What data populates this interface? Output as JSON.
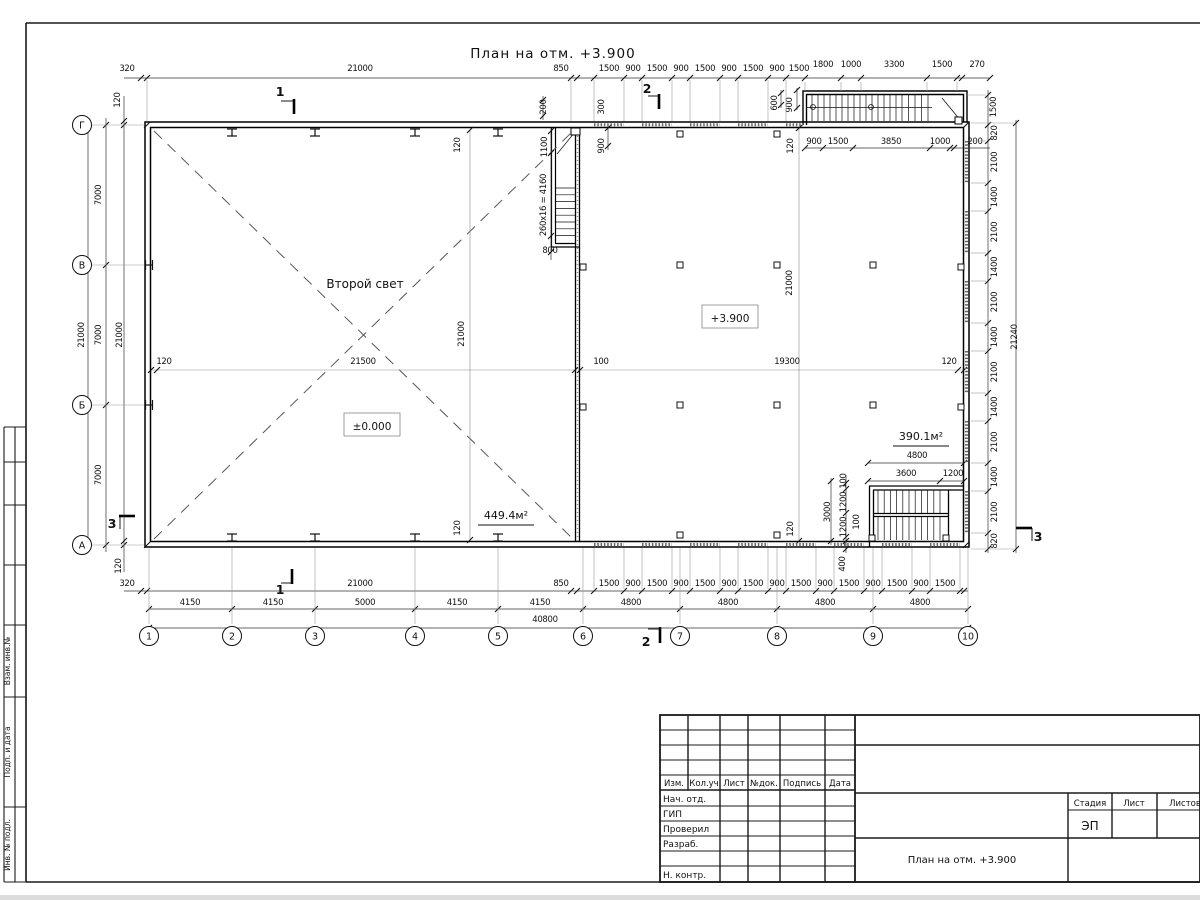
{
  "sheet_title": "План на отм. +3.900",
  "plan": {
    "room_labels": {
      "second_light": "Второй свет",
      "level_zero": "±0.000",
      "level_3900": "+3.900",
      "area_left": "449.4м²",
      "area_right": "390.1м²"
    },
    "axes_left": [
      "Г",
      "В",
      "Б",
      "А"
    ],
    "axes_bottom": [
      "1",
      "2",
      "3",
      "4",
      "5",
      "6",
      "7",
      "8",
      "9",
      "10"
    ],
    "dim_labels": [
      {
        "t": "320",
        "x": 127,
        "y": 71,
        "r": 0
      },
      {
        "t": "21000",
        "x": 360,
        "y": 71,
        "r": 0
      },
      {
        "t": "850",
        "x": 561,
        "y": 71,
        "r": 0
      },
      {
        "t": "1500",
        "x": 609,
        "y": 71,
        "r": 0
      },
      {
        "t": "900",
        "x": 633,
        "y": 71,
        "r": 0
      },
      {
        "t": "1500",
        "x": 657,
        "y": 71,
        "r": 0
      },
      {
        "t": "900",
        "x": 681,
        "y": 71,
        "r": 0
      },
      {
        "t": "1500",
        "x": 705,
        "y": 71,
        "r": 0
      },
      {
        "t": "900",
        "x": 729,
        "y": 71,
        "r": 0
      },
      {
        "t": "1500",
        "x": 753,
        "y": 71,
        "r": 0
      },
      {
        "t": "900",
        "x": 777,
        "y": 71,
        "r": 0
      },
      {
        "t": "1500",
        "x": 799,
        "y": 71,
        "r": 0
      },
      {
        "t": "1800",
        "x": 823,
        "y": 67,
        "r": 0
      },
      {
        "t": "1000",
        "x": 851,
        "y": 67,
        "r": 0
      },
      {
        "t": "3300",
        "x": 894,
        "y": 67,
        "r": 0
      },
      {
        "t": "1500",
        "x": 942,
        "y": 67,
        "r": 0
      },
      {
        "t": "270",
        "x": 977,
        "y": 67,
        "r": 0
      },
      {
        "t": "900",
        "x": 814,
        "y": 144,
        "r": 0
      },
      {
        "t": "1500",
        "x": 838,
        "y": 144,
        "r": 0
      },
      {
        "t": "3850",
        "x": 891,
        "y": 144,
        "r": 0
      },
      {
        "t": "1000",
        "x": 940,
        "y": 144,
        "r": 0
      },
      {
        "t": "200",
        "x": 975,
        "y": 144,
        "r": 0
      },
      {
        "t": "120",
        "x": 120,
        "y": 100,
        "r": 1
      },
      {
        "t": "200",
        "x": 546,
        "y": 107,
        "r": 1
      },
      {
        "t": "300",
        "x": 604,
        "y": 107,
        "r": 1
      },
      {
        "t": "900",
        "x": 604,
        "y": 146,
        "r": 1
      },
      {
        "t": "1100",
        "x": 547,
        "y": 147,
        "r": 1
      },
      {
        "t": "260x16 = 4160",
        "x": 546,
        "y": 205,
        "r": 1
      },
      {
        "t": "800",
        "x": 550,
        "y": 253,
        "r": 0
      },
      {
        "t": "600",
        "x": 777,
        "y": 103,
        "r": 1
      },
      {
        "t": "900",
        "x": 792,
        "y": 105,
        "r": 1
      },
      {
        "t": "120",
        "x": 793,
        "y": 146,
        "r": 1
      },
      {
        "t": "120",
        "x": 460,
        "y": 145,
        "r": 1
      },
      {
        "t": "120",
        "x": 460,
        "y": 528,
        "r": 1
      },
      {
        "t": "120",
        "x": 793,
        "y": 529,
        "r": 1
      },
      {
        "t": "1500",
        "x": 996,
        "y": 107,
        "r": 1
      },
      {
        "t": "820",
        "x": 997,
        "y": 133,
        "r": 1
      },
      {
        "t": "2100",
        "x": 997,
        "y": 162,
        "r": 1
      },
      {
        "t": "1400",
        "x": 997,
        "y": 197,
        "r": 1
      },
      {
        "t": "2100",
        "x": 997,
        "y": 232,
        "r": 1
      },
      {
        "t": "1400",
        "x": 997,
        "y": 267,
        "r": 1
      },
      {
        "t": "2100",
        "x": 997,
        "y": 302,
        "r": 1
      },
      {
        "t": "1400",
        "x": 997,
        "y": 337,
        "r": 1
      },
      {
        "t": "2100",
        "x": 997,
        "y": 372,
        "r": 1
      },
      {
        "t": "1400",
        "x": 997,
        "y": 407,
        "r": 1
      },
      {
        "t": "2100",
        "x": 997,
        "y": 442,
        "r": 1
      },
      {
        "t": "1400",
        "x": 997,
        "y": 477,
        "r": 1
      },
      {
        "t": "2100",
        "x": 997,
        "y": 512,
        "r": 1
      },
      {
        "t": "820",
        "x": 997,
        "y": 541,
        "r": 1
      },
      {
        "t": "21240",
        "x": 1017,
        "y": 337,
        "r": 1
      },
      {
        "t": "7000",
        "x": 101,
        "y": 195,
        "r": 1
      },
      {
        "t": "7000",
        "x": 101,
        "y": 335,
        "r": 1
      },
      {
        "t": "7000",
        "x": 101,
        "y": 475,
        "r": 1
      },
      {
        "t": "21000",
        "x": 84,
        "y": 335,
        "r": 1
      },
      {
        "t": "21000",
        "x": 122,
        "y": 335,
        "r": 1
      },
      {
        "t": "120",
        "x": 121,
        "y": 566,
        "r": 1
      },
      {
        "t": "120",
        "x": 164,
        "y": 364,
        "r": 0
      },
      {
        "t": "21500",
        "x": 363,
        "y": 364,
        "r": 0
      },
      {
        "t": "100",
        "x": 601,
        "y": 364,
        "r": 0
      },
      {
        "t": "19300",
        "x": 787,
        "y": 364,
        "r": 0
      },
      {
        "t": "120",
        "x": 949,
        "y": 364,
        "r": 0
      },
      {
        "t": "21000",
        "x": 464,
        "y": 334,
        "r": 1
      },
      {
        "t": "21000",
        "x": 792,
        "y": 283,
        "r": 1
      },
      {
        "t": "4800",
        "x": 917,
        "y": 458,
        "r": 0
      },
      {
        "t": "3600",
        "x": 906,
        "y": 476,
        "r": 0
      },
      {
        "t": "1200",
        "x": 953,
        "y": 476,
        "r": 0
      },
      {
        "t": "100",
        "x": 846,
        "y": 481,
        "r": 1
      },
      {
        "t": "1200",
        "x": 846,
        "y": 502,
        "r": 1
      },
      {
        "t": "1200",
        "x": 846,
        "y": 527,
        "r": 1
      },
      {
        "t": "100",
        "x": 859,
        "y": 522,
        "r": 1
      },
      {
        "t": "3000",
        "x": 830,
        "y": 512,
        "r": 1
      },
      {
        "t": "400",
        "x": 845,
        "y": 564,
        "r": 1
      },
      {
        "t": "320",
        "x": 127,
        "y": 586,
        "r": 0
      },
      {
        "t": "21000",
        "x": 360,
        "y": 586,
        "r": 0
      },
      {
        "t": "850",
        "x": 561,
        "y": 586,
        "r": 0
      },
      {
        "t": "1500",
        "x": 609,
        "y": 586,
        "r": 0
      },
      {
        "t": "900",
        "x": 633,
        "y": 586,
        "r": 0
      },
      {
        "t": "1500",
        "x": 657,
        "y": 586,
        "r": 0
      },
      {
        "t": "900",
        "x": 681,
        "y": 586,
        "r": 0
      },
      {
        "t": "1500",
        "x": 705,
        "y": 586,
        "r": 0
      },
      {
        "t": "900",
        "x": 729,
        "y": 586,
        "r": 0
      },
      {
        "t": "1500",
        "x": 753,
        "y": 586,
        "r": 0
      },
      {
        "t": "900",
        "x": 777,
        "y": 586,
        "r": 0
      },
      {
        "t": "1500",
        "x": 801,
        "y": 586,
        "r": 0
      },
      {
        "t": "900",
        "x": 825,
        "y": 586,
        "r": 0
      },
      {
        "t": "1500",
        "x": 849,
        "y": 586,
        "r": 0
      },
      {
        "t": "900",
        "x": 873,
        "y": 586,
        "r": 0
      },
      {
        "t": "1500",
        "x": 897,
        "y": 586,
        "r": 0
      },
      {
        "t": "900",
        "x": 921,
        "y": 586,
        "r": 0
      },
      {
        "t": "1500",
        "x": 945,
        "y": 586,
        "r": 0
      },
      {
        "t": "4150",
        "x": 190,
        "y": 605,
        "r": 0
      },
      {
        "t": "4150",
        "x": 273,
        "y": 605,
        "r": 0
      },
      {
        "t": "5000",
        "x": 365,
        "y": 605,
        "r": 0
      },
      {
        "t": "4150",
        "x": 457,
        "y": 605,
        "r": 0
      },
      {
        "t": "4150",
        "x": 540,
        "y": 605,
        "r": 0
      },
      {
        "t": "4800",
        "x": 631,
        "y": 605,
        "r": 0
      },
      {
        "t": "4800",
        "x": 728,
        "y": 605,
        "r": 0
      },
      {
        "t": "4800",
        "x": 825,
        "y": 605,
        "r": 0
      },
      {
        "t": "4800",
        "x": 920,
        "y": 605,
        "r": 0
      },
      {
        "t": "40800",
        "x": 545,
        "y": 622,
        "r": 0
      },
      {
        "t": "1",
        "x": 280,
        "y": 96,
        "r": 0,
        "s": 1
      },
      {
        "t": "1",
        "x": 280,
        "y": 594,
        "r": 0,
        "s": 1
      },
      {
        "t": "2",
        "x": 647,
        "y": 93,
        "r": 0,
        "s": 1
      },
      {
        "t": "2",
        "x": 646,
        "y": 646,
        "r": 0,
        "s": 1
      },
      {
        "t": "3",
        "x": 112,
        "y": 528,
        "r": 0,
        "s": 1
      },
      {
        "t": "3",
        "x": 1038,
        "y": 541,
        "r": 0,
        "s": 1
      }
    ]
  },
  "titleblock": {
    "cols": [
      "Изм.",
      "Кол.уч",
      "Лист",
      "№док.",
      "Подпись",
      "Дата"
    ],
    "rows": [
      "Нач. отд.",
      "ГИП",
      "Проверил",
      "Разраб.",
      "Н. контр."
    ],
    "stage_cols": [
      "Стадия",
      "Лист",
      "Листов"
    ],
    "stage": "ЭП",
    "doc_title": "План на отм. +3.900"
  },
  "side_stamps": [
    "Взам. инв.№",
    "Подп. и дата",
    "Инв. № подл."
  ]
}
